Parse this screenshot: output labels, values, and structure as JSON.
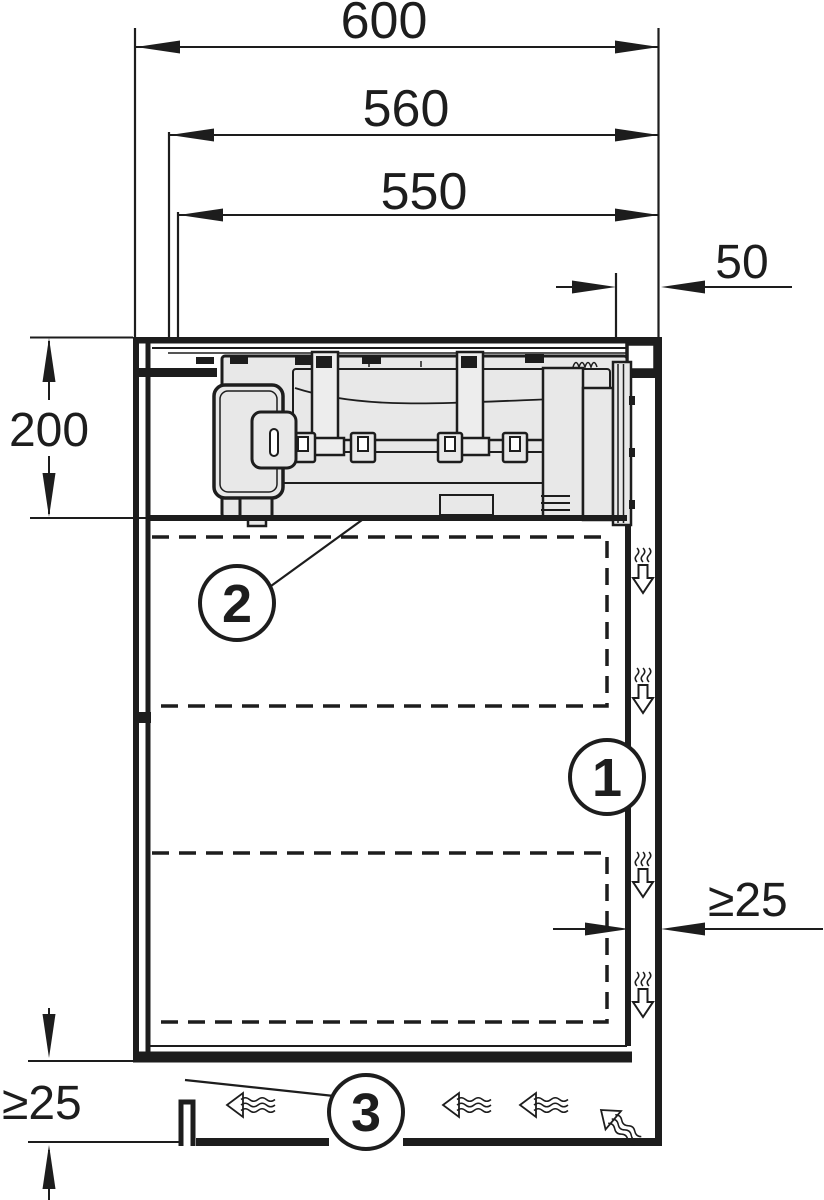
{
  "dimensions": {
    "overall_width": "600",
    "inner_width": "560",
    "cutout_width": "550",
    "side_clearance": "50",
    "unit_depth": "200",
    "rear_clearance": "≥25",
    "plinth_clearance": "≥25"
  },
  "callouts": {
    "extraction_channel": "1",
    "unit_clearance": "2",
    "plinth_outlet": "3"
  },
  "colors": {
    "line": "#1d1d1d",
    "appliance_fill": "#e8e8e8",
    "background": "#ffffff"
  }
}
